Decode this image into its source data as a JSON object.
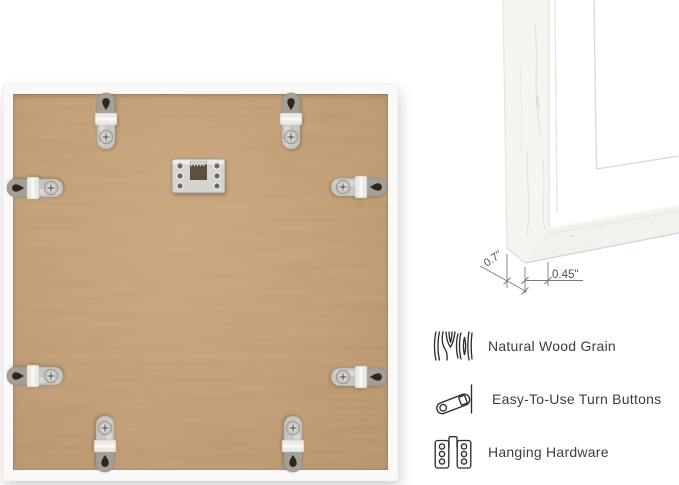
{
  "colors": {
    "background": "#ffffff",
    "mdf_board": "#c49e74",
    "frame_white": "#faf9f7",
    "metal_silver": "#c8c6c2",
    "feature_text": "#3d3d3d",
    "dimension_text": "#4d4d4d"
  },
  "frame_back": {
    "hanger_icon": "sawtooth-hanger",
    "turn_buttons": [
      {
        "cx": 103,
        "cy": 37,
        "rotation": 0
      },
      {
        "cx": 288,
        "cy": 37,
        "rotation": 0
      },
      {
        "cx": 32,
        "cy": 104,
        "rotation": -90
      },
      {
        "cx": 356,
        "cy": 103,
        "rotation": 90
      },
      {
        "cx": 32,
        "cy": 292,
        "rotation": -90
      },
      {
        "cx": 356,
        "cy": 293,
        "rotation": 90
      },
      {
        "cx": 102,
        "cy": 360,
        "rotation": 180
      },
      {
        "cx": 290,
        "cy": 360,
        "rotation": 180
      }
    ]
  },
  "corner_detail": {
    "side_label": "0.7\"",
    "depth_label": "0.45\""
  },
  "features": [
    {
      "icon": "wood-grain-icon",
      "label": "Natural Wood Grain"
    },
    {
      "icon": "turn-button-icon",
      "label": "Easy-To-Use Turn Buttons"
    },
    {
      "icon": "hanging-hardware-icon",
      "label": "Hanging Hardware"
    }
  ]
}
